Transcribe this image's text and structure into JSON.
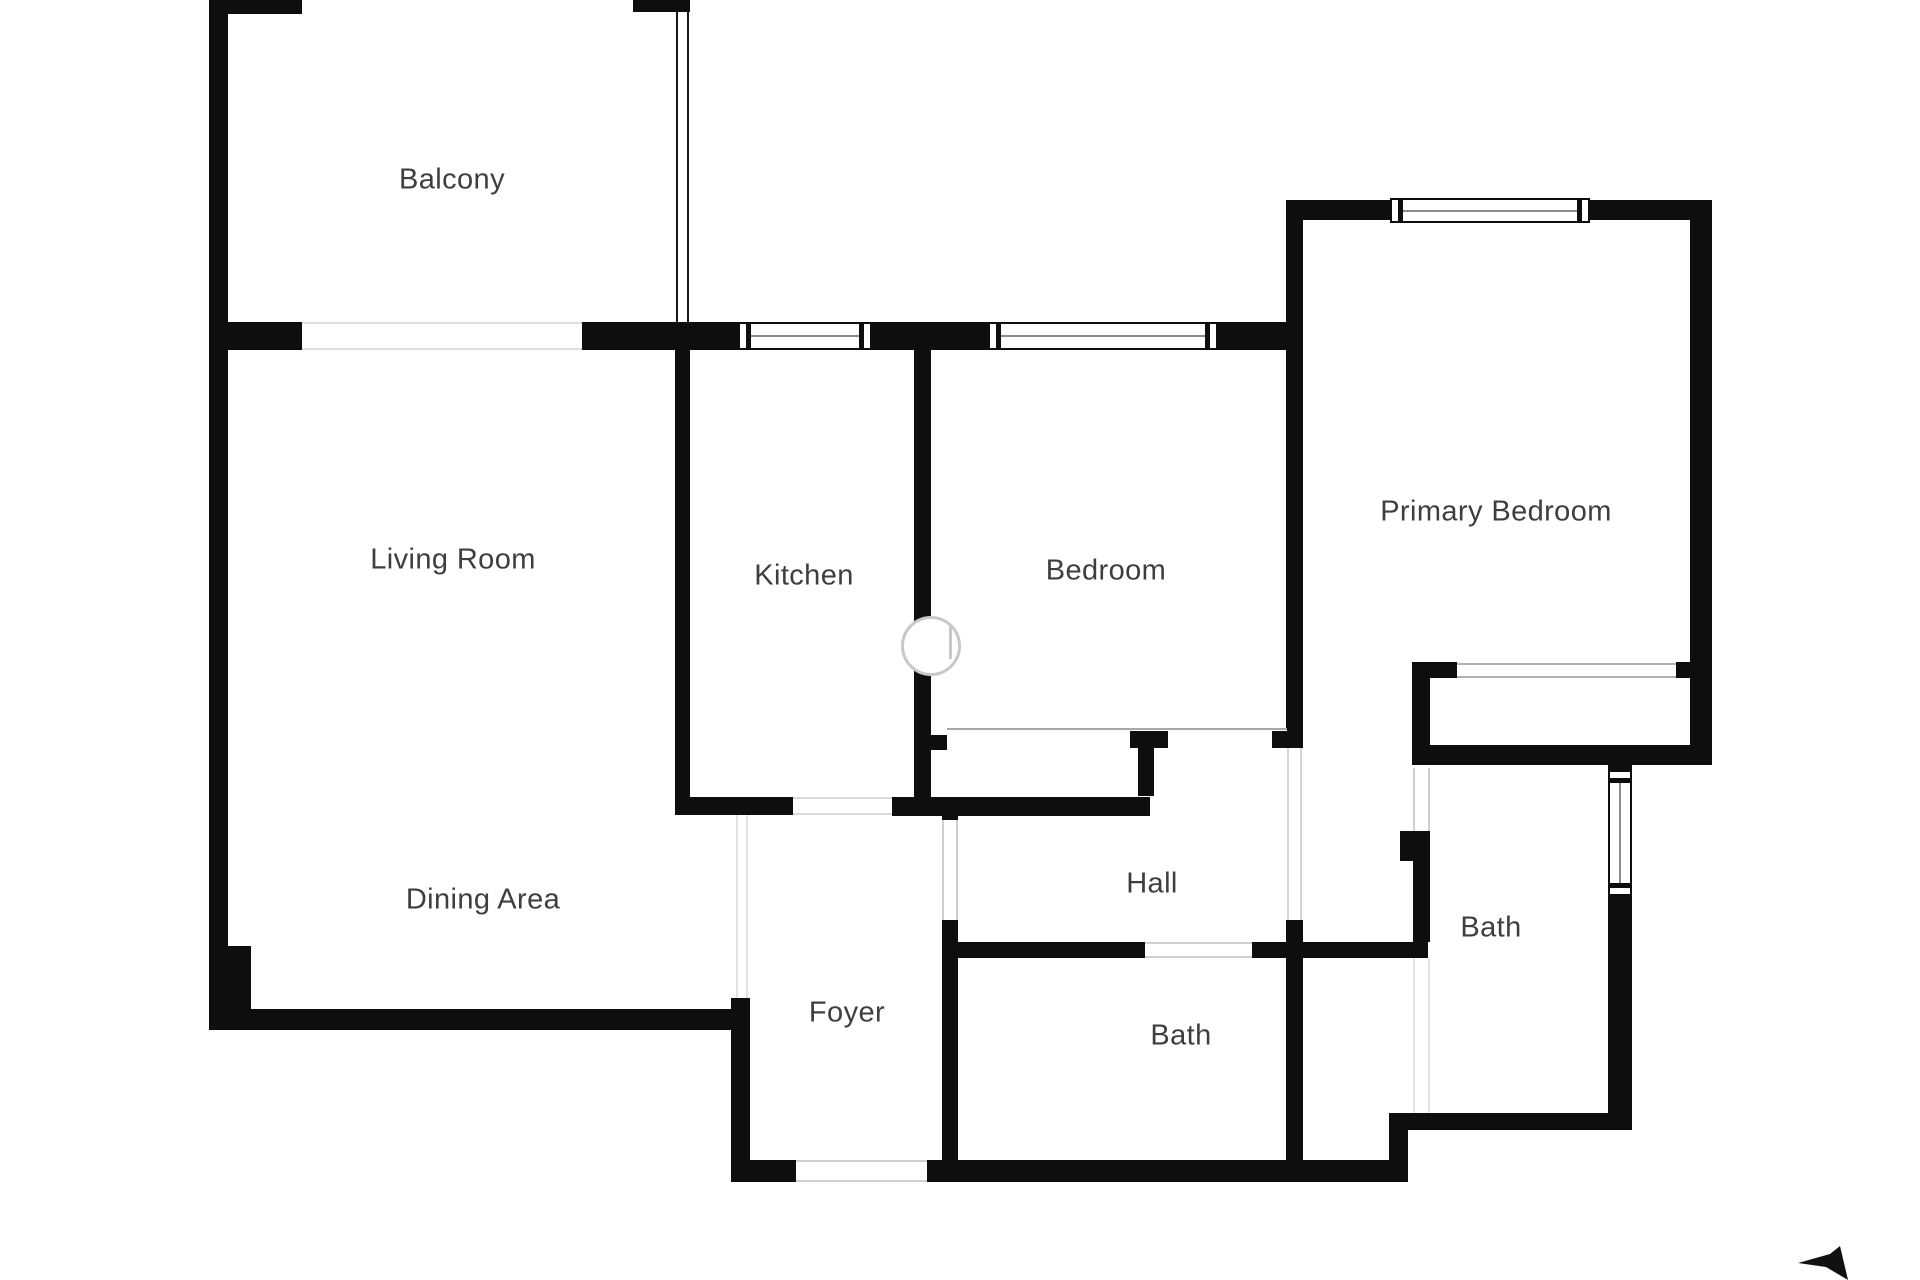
{
  "plan": {
    "width": 1920,
    "height": 1280,
    "background": "#ffffff",
    "wall_color": "#0e0e0e",
    "label_color": "#3e3e3e",
    "label_font_size": 29,
    "rooms": [
      {
        "id": "balcony",
        "label": "Balcony",
        "cx": 452,
        "cy": 180
      },
      {
        "id": "living-room",
        "label": "Living Room",
        "cx": 453,
        "cy": 560
      },
      {
        "id": "kitchen",
        "label": "Kitchen",
        "cx": 804,
        "cy": 576
      },
      {
        "id": "bedroom",
        "label": "Bedroom",
        "cx": 1106,
        "cy": 571
      },
      {
        "id": "primary-bedroom",
        "label": "Primary Bedroom",
        "cx": 1496,
        "cy": 512
      },
      {
        "id": "dining-area",
        "label": "Dining Area",
        "cx": 483,
        "cy": 900
      },
      {
        "id": "hall",
        "label": "Hall",
        "cx": 1152,
        "cy": 884
      },
      {
        "id": "foyer",
        "label": "Foyer",
        "cx": 847,
        "cy": 1013
      },
      {
        "id": "bath-middle",
        "label": "Bath",
        "cx": 1181,
        "cy": 1036
      },
      {
        "id": "bath-right",
        "label": "Bath",
        "cx": 1491,
        "cy": 928
      }
    ],
    "walls": [
      [
        209,
        0,
        19,
        1030
      ],
      [
        209,
        0,
        93,
        14
      ],
      [
        633,
        0,
        57,
        12
      ],
      [
        209,
        322,
        93,
        28
      ],
      [
        582,
        322,
        156,
        28
      ],
      [
        872,
        322,
        116,
        28
      ],
      [
        1218,
        322,
        68,
        28
      ],
      [
        675,
        350,
        15,
        465
      ],
      [
        914,
        350,
        17,
        466
      ],
      [
        1286,
        200,
        17,
        548
      ],
      [
        1272,
        730,
        14,
        18
      ],
      [
        1286,
        200,
        104,
        20
      ],
      [
        1590,
        200,
        122,
        20
      ],
      [
        1690,
        200,
        22,
        565
      ],
      [
        1412,
        662,
        18,
        103
      ],
      [
        1412,
        662,
        45,
        16
      ],
      [
        1676,
        662,
        16,
        16
      ],
      [
        1412,
        745,
        300,
        20
      ],
      [
        1608,
        765,
        24,
        8
      ],
      [
        1608,
        895,
        24,
        235
      ],
      [
        1408,
        1113,
        222,
        17
      ],
      [
        1389,
        1113,
        19,
        69
      ],
      [
        731,
        1160,
        65,
        22
      ],
      [
        927,
        1160,
        481,
        22
      ],
      [
        731,
        998,
        19,
        184
      ],
      [
        251,
        1009,
        487,
        21
      ],
      [
        209,
        946,
        42,
        84
      ],
      [
        675,
        797,
        118,
        18
      ],
      [
        892,
        797,
        258,
        19
      ],
      [
        942,
        808,
        16,
        12
      ],
      [
        942,
        920,
        16,
        242
      ],
      [
        958,
        942,
        187,
        16
      ],
      [
        1252,
        942,
        34,
        16
      ],
      [
        1286,
        920,
        17,
        242
      ],
      [
        1286,
        942,
        28,
        16
      ],
      [
        1303,
        942,
        125,
        16
      ],
      [
        1400,
        831,
        30,
        30
      ],
      [
        1413,
        861,
        17,
        81
      ],
      [
        1130,
        730,
        38,
        18
      ],
      [
        1138,
        748,
        16,
        48
      ],
      [
        931,
        735,
        16,
        15
      ]
    ],
    "openings": [
      {
        "name": "balcony-opening",
        "x": 302,
        "y": 322,
        "w": 280,
        "h": 28,
        "sides": "tb",
        "color": "#dedede"
      },
      {
        "name": "balcony-railing",
        "x": 676,
        "y": 12,
        "w": 13,
        "h": 310,
        "sides": "lr",
        "color": "#161616"
      },
      {
        "name": "dining-foyer-boundary",
        "x": 736,
        "y": 815,
        "w": 12,
        "h": 183,
        "sides": "lr",
        "color": "#e2e2e2"
      },
      {
        "name": "bedroom-closet-front",
        "x": 947,
        "y": 728,
        "w": 340,
        "h": 3,
        "sides": "t",
        "color": "#a8a8a8"
      },
      {
        "name": "foyer-hall-door",
        "x": 942,
        "y": 820,
        "w": 16,
        "h": 100,
        "sides": "lr",
        "color": "#cfcfcf"
      },
      {
        "name": "hall-bath-door",
        "x": 1145,
        "y": 942,
        "w": 107,
        "h": 16,
        "sides": "tb",
        "color": "#cfcfcf"
      },
      {
        "name": "entrance-door",
        "x": 796,
        "y": 1160,
        "w": 131,
        "h": 22,
        "sides": "tb",
        "color": "#cfcfcf"
      },
      {
        "name": "primary-suite-door",
        "x": 1287,
        "y": 748,
        "w": 15,
        "h": 172,
        "sides": "lr",
        "color": "#d6d6d6"
      },
      {
        "name": "bath-right-door",
        "x": 1413,
        "y": 768,
        "w": 17,
        "h": 63,
        "sides": "lr",
        "color": "#cfcfcf"
      },
      {
        "name": "primary-closet-front",
        "x": 1457,
        "y": 663,
        "w": 219,
        "h": 15,
        "sides": "tb",
        "color": "#b2b2b2"
      },
      {
        "name": "kitchen-door",
        "x": 793,
        "y": 797,
        "w": 99,
        "h": 18,
        "sides": "tb",
        "color": "#dadada"
      },
      {
        "name": "bath-lobby-boundary",
        "x": 1413,
        "y": 958,
        "w": 17,
        "h": 155,
        "sides": "lr",
        "color": "#e4e4e4"
      }
    ],
    "windows": [
      {
        "name": "kitchen-window",
        "x": 738,
        "y": 322,
        "w": 134,
        "h": 28,
        "o": "h"
      },
      {
        "name": "bedroom-window",
        "x": 988,
        "y": 322,
        "w": 230,
        "h": 28,
        "o": "h"
      },
      {
        "name": "primary-bedroom-window",
        "x": 1390,
        "y": 198,
        "w": 200,
        "h": 25,
        "o": "h"
      },
      {
        "name": "bath-window",
        "x": 1608,
        "y": 770,
        "w": 24,
        "h": 126,
        "o": "v"
      }
    ],
    "watermark": {
      "cx": 931,
      "cy": 646,
      "r": 27,
      "ring": "#c8c8c8"
    },
    "compass": {
      "points": "1798,1263 1830,1254 1840,1246 1848,1280 1826,1267",
      "color": "#111111"
    }
  }
}
